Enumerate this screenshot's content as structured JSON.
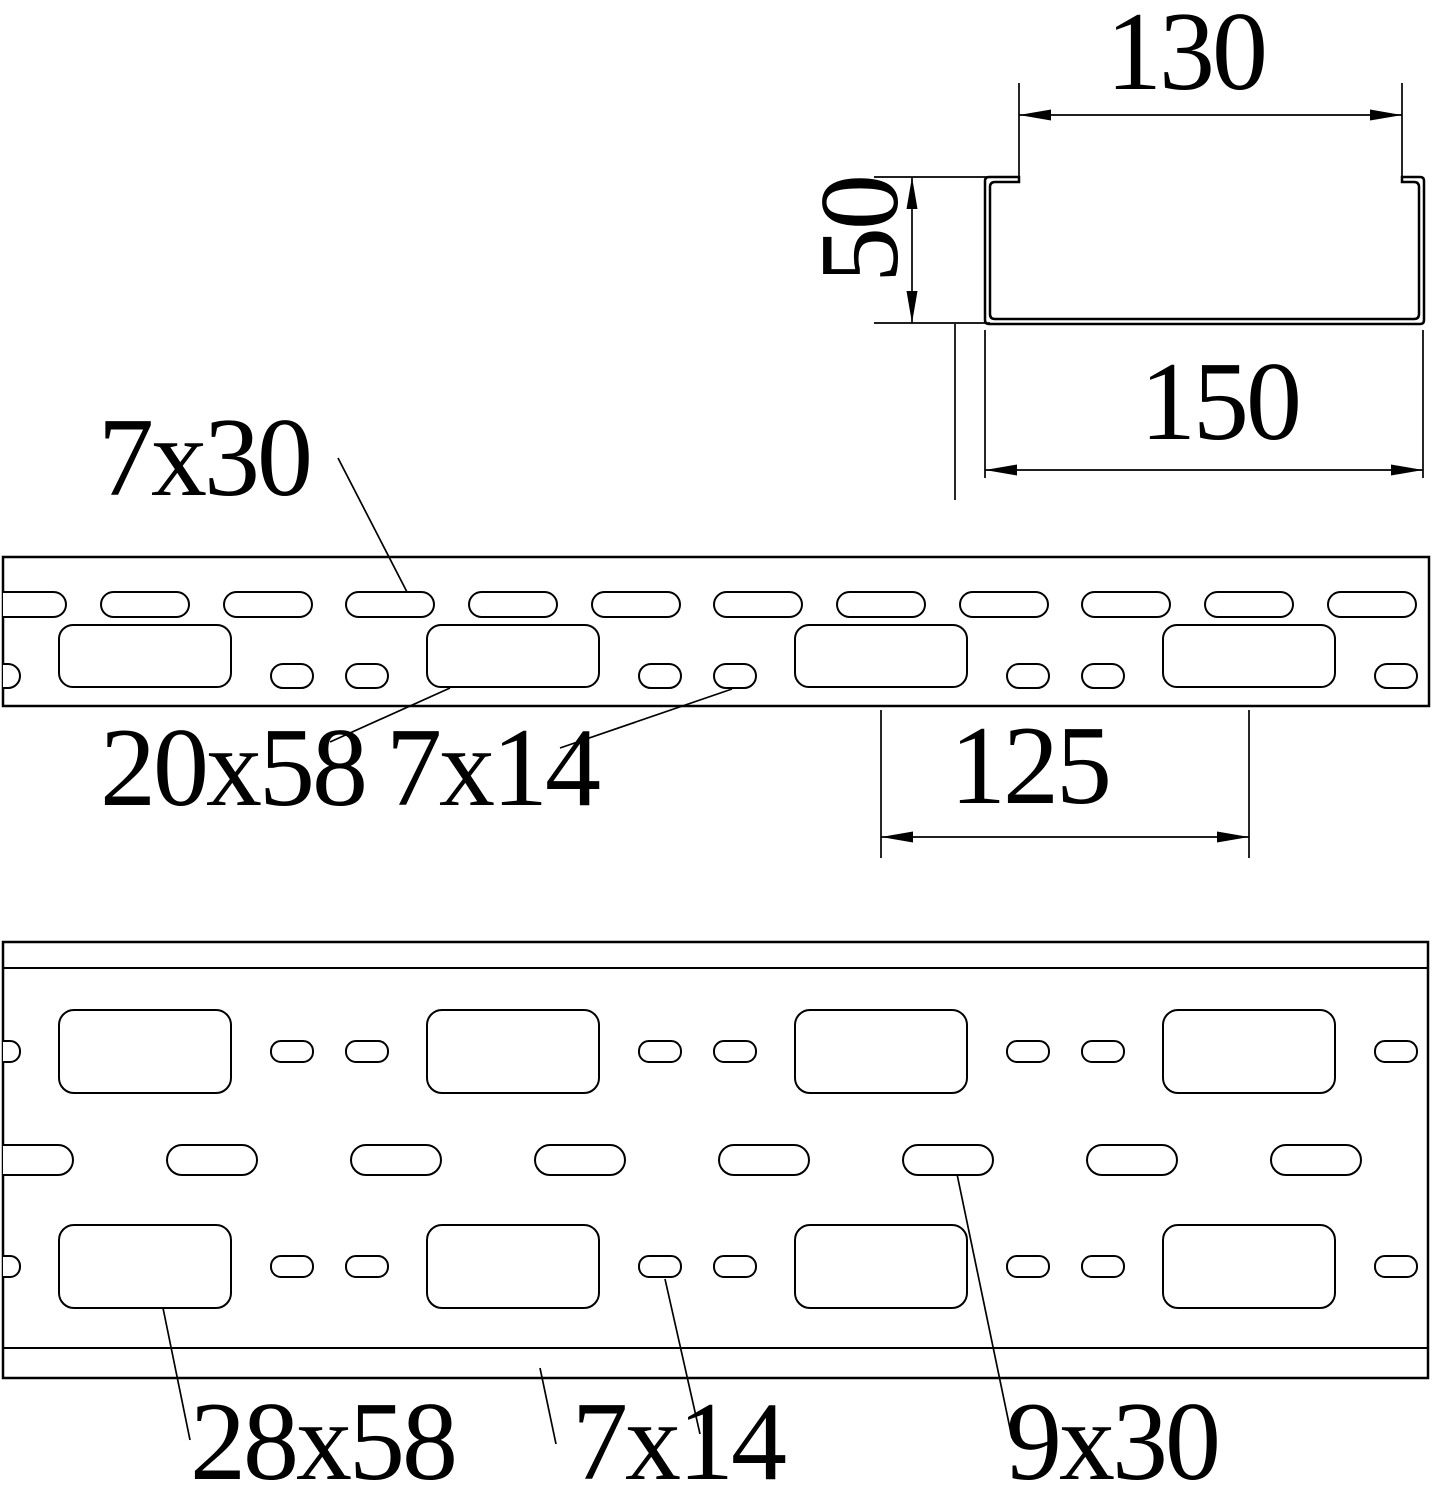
{
  "cross_section": {
    "inner_width": "130",
    "height": "50",
    "outer_width": "150"
  },
  "side_view": {
    "top_slot": "7x30",
    "large_slot": "20x58",
    "small_slot": "7x14",
    "pitch": "125"
  },
  "plan_view": {
    "large_slot": "28x58",
    "small_slot": "7x14",
    "mid_slot": "9x30"
  }
}
